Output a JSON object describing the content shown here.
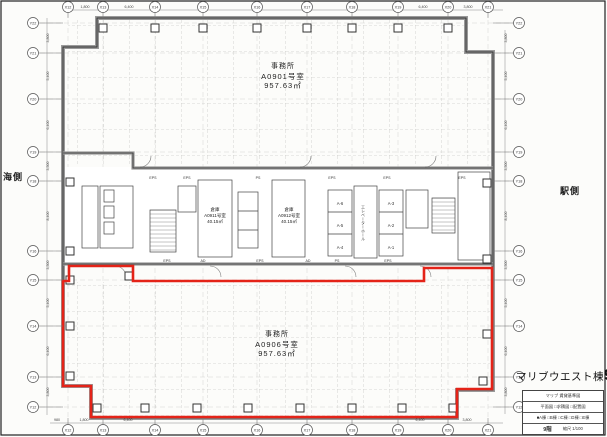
{
  "building": {
    "title": "マリブウエスト棟",
    "floor_big": "9",
    "floor_suffix": "階"
  },
  "sides": {
    "left": "海側",
    "right": "駅側"
  },
  "rooms": {
    "office_upper": {
      "type": "事務所",
      "number": "A0901号室",
      "area": "957.63㎡"
    },
    "office_lower": {
      "type": "事務所",
      "number": "A0906号室",
      "area": "957.63㎡"
    },
    "storage_left": {
      "type": "倉庫",
      "number": "A0911号室",
      "area": "40.15㎡"
    },
    "storage_right": {
      "type": "倉庫",
      "number": "A0912号室",
      "area": "40.15㎡"
    }
  },
  "core": {
    "elevator_hall": "エレベーターホール",
    "elevators": [
      {
        "label": "A-6",
        "x": 340,
        "y": 205
      },
      {
        "label": "A-5",
        "x": 340,
        "y": 227
      },
      {
        "label": "A-4",
        "x": 340,
        "y": 249
      },
      {
        "label": "A-3",
        "x": 391,
        "y": 205
      },
      {
        "label": "A-2",
        "x": 391,
        "y": 227
      },
      {
        "label": "A-1",
        "x": 391,
        "y": 249
      }
    ],
    "service_labels": [
      {
        "t": "EPS",
        "x": 153,
        "y": 179
      },
      {
        "t": "EPS",
        "x": 187,
        "y": 179
      },
      {
        "t": "PS",
        "x": 258,
        "y": 179
      },
      {
        "t": "EPS",
        "x": 332,
        "y": 179
      },
      {
        "t": "EPS",
        "x": 387,
        "y": 179
      },
      {
        "t": "EPS",
        "x": 462,
        "y": 179
      },
      {
        "t": "EPS",
        "x": 167,
        "y": 262
      },
      {
        "t": "AD",
        "x": 203,
        "y": 262
      },
      {
        "t": "EPS",
        "x": 260,
        "y": 262
      },
      {
        "t": "AD",
        "x": 308,
        "y": 262
      },
      {
        "t": "PS",
        "x": 337,
        "y": 262
      },
      {
        "t": "EPS",
        "x": 388,
        "y": 262
      }
    ]
  },
  "grid": {
    "x_bubbles": [
      {
        "label": "X12",
        "x": 68
      },
      {
        "label": "X13",
        "x": 103
      },
      {
        "label": "X14",
        "x": 155
      },
      {
        "label": "X15",
        "x": 203
      },
      {
        "label": "X16",
        "x": 257
      },
      {
        "label": "X17",
        "x": 307
      },
      {
        "label": "X18",
        "x": 352
      },
      {
        "label": "X19",
        "x": 398
      },
      {
        "label": "X20",
        "x": 448
      },
      {
        "label": "X21",
        "x": 488
      }
    ],
    "y_bubbles": [
      {
        "label": "Y22",
        "y": 23
      },
      {
        "label": "Y21",
        "y": 53
      },
      {
        "label": "Y20",
        "y": 99
      },
      {
        "label": "Y19",
        "y": 152
      },
      {
        "label": "Y18",
        "y": 181
      },
      {
        "label": "Y16",
        "y": 251
      },
      {
        "label": "Y15",
        "y": 280
      },
      {
        "label": "Y14",
        "y": 326
      },
      {
        "label": "Y13",
        "y": 377
      },
      {
        "label": "Y12",
        "y": 407
      }
    ],
    "dims_top": [
      {
        "t": "1,800",
        "x": 85
      },
      {
        "t": "6,400",
        "x": 129
      },
      {
        "t": "6,400",
        "x": 423
      },
      {
        "t": "3,800",
        "x": 468
      }
    ],
    "dims_bottom": [
      {
        "t": "980",
        "x": 57
      },
      {
        "t": "1,800",
        "x": 84
      },
      {
        "t": "6,400",
        "x": 128
      },
      {
        "t": "6,400",
        "x": 420
      },
      {
        "t": "3,800",
        "x": 467
      }
    ],
    "dims_left": [
      {
        "t": "3,800",
        "y": 38
      },
      {
        "t": "5,400",
        "y": 76
      },
      {
        "t": "6,400",
        "y": 125
      },
      {
        "t": "3,500",
        "y": 166
      },
      {
        "t": "8,400",
        "y": 216
      },
      {
        "t": "3,500",
        "y": 265
      },
      {
        "t": "5,400",
        "y": 303
      },
      {
        "t": "6,400",
        "y": 351
      },
      {
        "t": "3,800",
        "y": 392
      }
    ],
    "dims_right": [
      {
        "t": "3,800",
        "y": 38
      },
      {
        "t": "5,400",
        "y": 76
      },
      {
        "t": "6,400",
        "y": 125
      },
      {
        "t": "3,500",
        "y": 166
      },
      {
        "t": "8,400",
        "y": 216
      },
      {
        "t": "3,500",
        "y": 265
      },
      {
        "t": "5,400",
        "y": 303
      },
      {
        "t": "6,400",
        "y": 351
      },
      {
        "t": "3,800",
        "y": 392
      }
    ]
  },
  "title_block": {
    "row1": "マリブ 賃貸基準図",
    "row2": "平面図 □求積図 □配置図",
    "row3": "■A棟 □B棟 □C棟 □D棟 □E棟",
    "row4_floor": "9階",
    "row4_scale": "縮尺 1/100"
  },
  "colors": {
    "highlight_red": "#e42318",
    "wall_gray": "#9a9a9a",
    "line_dark": "#333333"
  }
}
